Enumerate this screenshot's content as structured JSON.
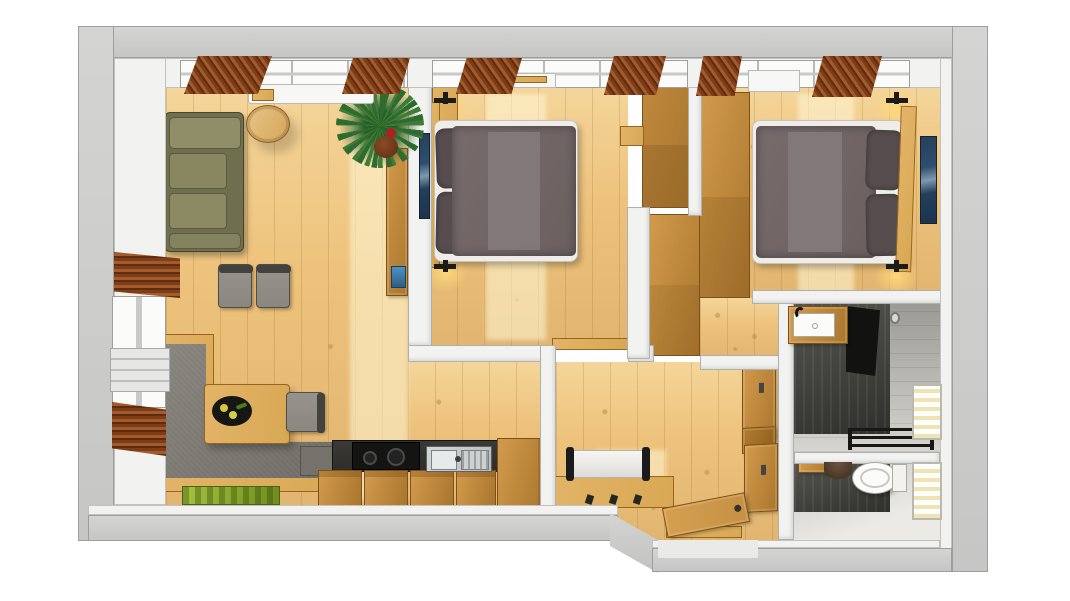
{
  "scene": {
    "title": "3D apartment floor plan, top-down view",
    "style": "photorealistic 3D render, no text labels",
    "background": "#ffffff"
  },
  "palette": {
    "wall_top": "#d4d4d2",
    "wall_face": "#f2f2f0",
    "floor_wood": "#edc27b",
    "cabinet_wood": "#c08a3e",
    "cabinet_edge": "#7d5118",
    "light_wood": "#d8a854",
    "sofa_olive": "#84835f",
    "bench_gray": "#7b7872",
    "chair_gray": "#8a8780",
    "mattress": "#f0ede8",
    "duvet": "#6b5f60",
    "duvet_runner": "#847a7b",
    "pillow": "#574d4e",
    "counter_dark": "#2e2d2a",
    "steel": "#b9bcbd",
    "curtain_brown": "#a35a2c",
    "artwork_blue": "#2f4e6e",
    "plant_green": "#2e6b2e",
    "mat_green": "#8fae2e",
    "tile_dark": "#3c3c3a",
    "shower_black": "#121210",
    "glow": "#ffd878",
    "door_wood": "#c69044"
  },
  "rooms": [
    {
      "id": "living-room",
      "name": "Living room"
    },
    {
      "id": "dining-area",
      "name": "Dining area"
    },
    {
      "id": "kitchen",
      "name": "Kitchen"
    },
    {
      "id": "bedroom-1",
      "name": "Bedroom 1"
    },
    {
      "id": "bedroom-2",
      "name": "Bedroom 2"
    },
    {
      "id": "hallway",
      "name": "Hallway / entrance"
    },
    {
      "id": "bathroom",
      "name": "Bathroom"
    },
    {
      "id": "wc",
      "name": "Separate WC"
    }
  ],
  "furniture": [
    {
      "id": "sofa",
      "name": "Olive green sofa",
      "room": "living-room"
    },
    {
      "id": "coffee-table",
      "name": "Round wooden side table",
      "room": "living-room"
    },
    {
      "id": "wall-art",
      "name": "Blue wall art",
      "room": "living-room"
    },
    {
      "id": "plant",
      "name": "Potted green plant",
      "room": "living-room"
    },
    {
      "id": "sideboard",
      "name": "Wall sideboard",
      "room": "living-room"
    },
    {
      "id": "corner-bench",
      "name": "Gray corner bench",
      "room": "dining-area"
    },
    {
      "id": "dining-table",
      "name": "Wooden dining table",
      "room": "dining-area"
    },
    {
      "id": "dining-chair",
      "name": "Gray dining chair",
      "room": "dining-area"
    },
    {
      "id": "serving-tray",
      "name": "Black serving tray",
      "room": "dining-area"
    },
    {
      "id": "door-mat",
      "name": "Green mat",
      "room": "dining-area"
    },
    {
      "id": "kitchen-counter",
      "name": "Kitchen counter with dark worktop",
      "room": "kitchen"
    },
    {
      "id": "cooktop",
      "name": "Black cooktop",
      "room": "kitchen"
    },
    {
      "id": "kitchen-sink",
      "name": "Stainless steel sink with drainer",
      "room": "kitchen"
    },
    {
      "id": "kitchen-cabinets",
      "name": "Wooden base cabinets",
      "room": "kitchen"
    },
    {
      "id": "tall-cabinet",
      "name": "Tall kitchen cabinet",
      "room": "kitchen"
    },
    {
      "id": "bed-1",
      "name": "Double bed with dark duvet",
      "room": "bedroom-1"
    },
    {
      "id": "wardrobe-1",
      "name": "Built-in wardrobe",
      "room": "bedroom-1"
    },
    {
      "id": "wall-lamp",
      "name": "Wall-mounted reading lamp",
      "room": "bedroom-1"
    },
    {
      "id": "bed-2",
      "name": "Double bed with dark duvet",
      "room": "bedroom-2"
    },
    {
      "id": "wardrobe-2",
      "name": "Large wardrobe",
      "room": "bedroom-2"
    },
    {
      "id": "hall-bench",
      "name": "Hall bench with white cushion",
      "room": "hallway"
    },
    {
      "id": "coat-hooks",
      "name": "Coat hooks",
      "room": "hallway"
    },
    {
      "id": "hall-wardrobe",
      "name": "Hallway wardrobe",
      "room": "hallway"
    },
    {
      "id": "entrance-door",
      "name": "Open entrance door",
      "room": "hallway"
    },
    {
      "id": "washbasin",
      "name": "Washbasin with wooden vanity",
      "room": "bathroom"
    },
    {
      "id": "shower",
      "name": "Walk-in shower with dark tiles",
      "room": "bathroom"
    },
    {
      "id": "towel-radiator",
      "name": "Towel radiator",
      "room": "bathroom"
    },
    {
      "id": "toilet",
      "name": "Toilet",
      "room": "wc"
    },
    {
      "id": "wc-basin",
      "name": "Small corner basin",
      "room": "wc"
    },
    {
      "id": "window",
      "name": "Window with blinds",
      "room": "bathroom"
    },
    {
      "id": "curtain",
      "name": "Brown curtains",
      "room": "living-room"
    }
  ]
}
